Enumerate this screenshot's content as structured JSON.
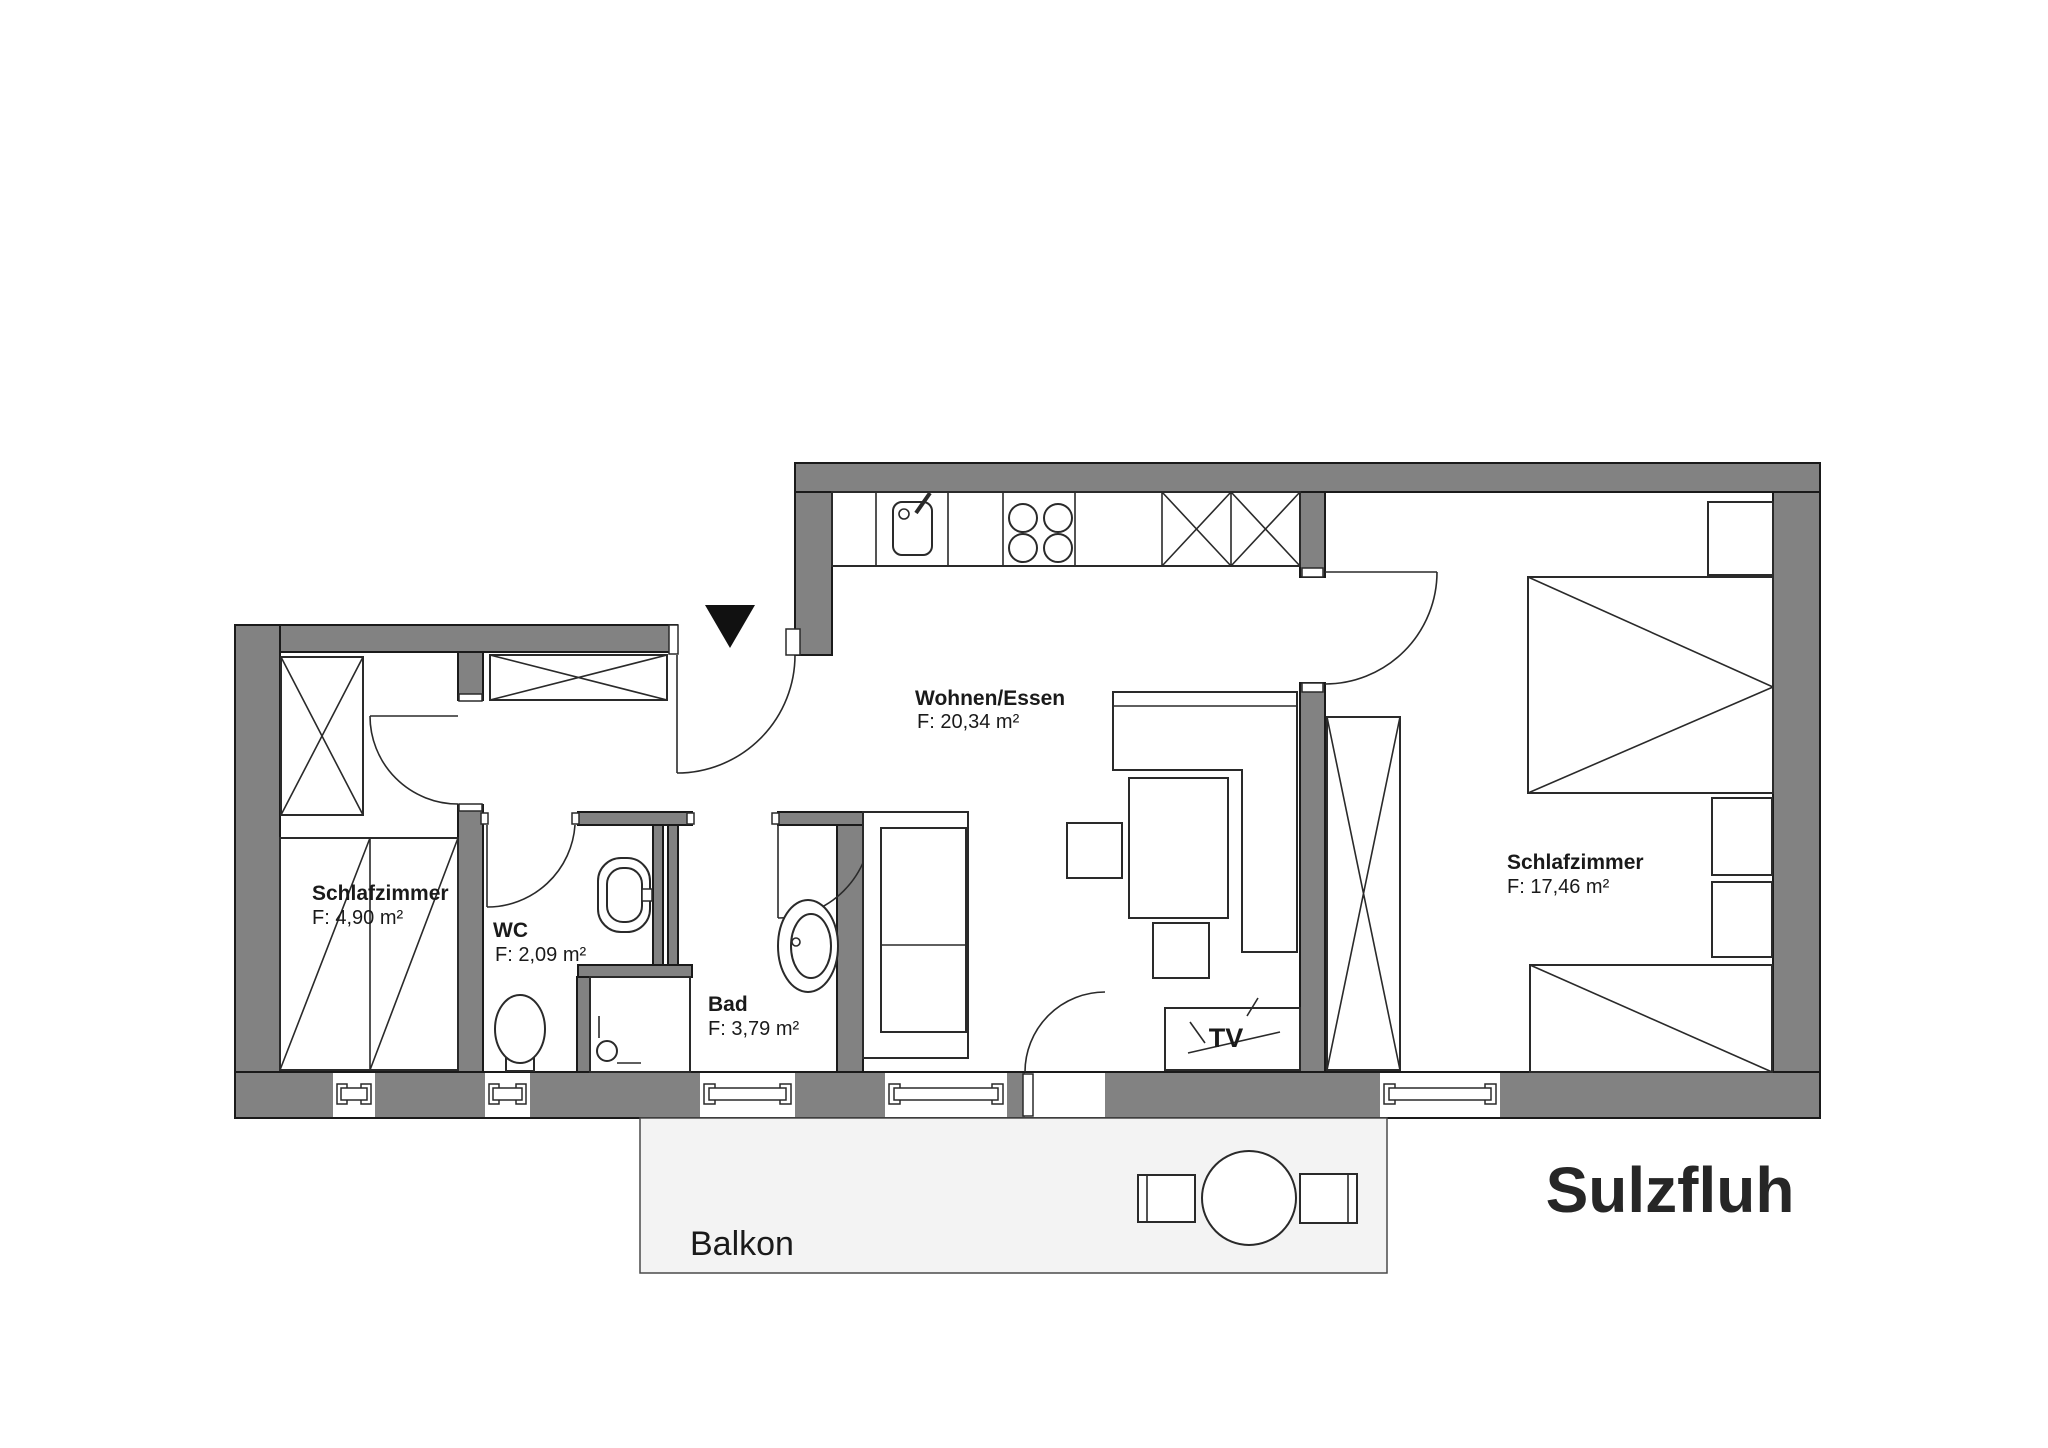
{
  "title": "Sulzfluh",
  "rooms": {
    "wohnen_essen": {
      "name": "Wohnen/Essen",
      "area": "F: 20,34 m²"
    },
    "schlafzimmer_links": {
      "name": "Schlafzimmer",
      "area": "F: 4,90 m²"
    },
    "wc": {
      "name": "WC",
      "area": "F: 2,09 m²"
    },
    "bad": {
      "name": "Bad",
      "area": "F: 3,79 m²"
    },
    "schlafzimmer_rechts": {
      "name": "Schlafzimmer",
      "area": "F: 17,46 m²"
    },
    "balkon": {
      "name": "Balkon"
    }
  },
  "labels": {
    "tv": "TV"
  },
  "colors": {
    "wall": "#828282",
    "outline": "#1a1a1a",
    "balcony_fill": "#f3f3f3",
    "entry_marker": "#111111",
    "text": "#1a1a1a"
  }
}
